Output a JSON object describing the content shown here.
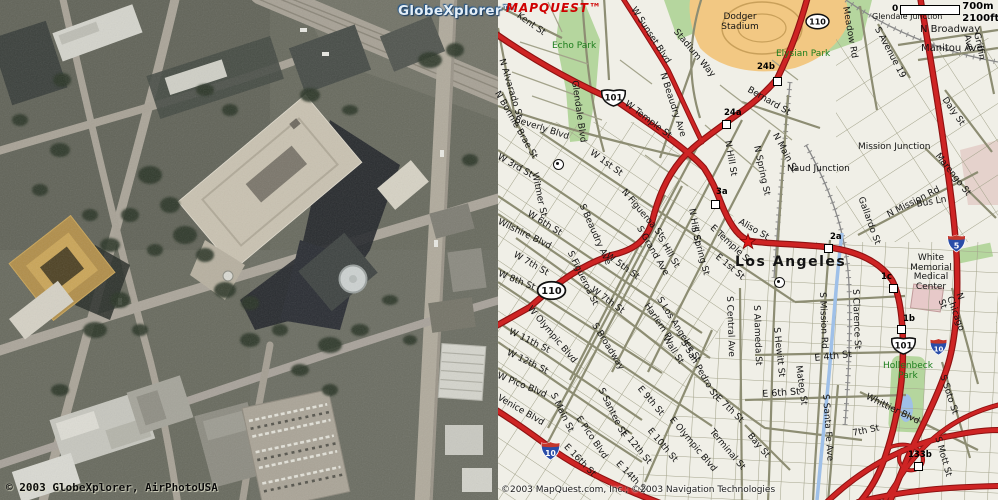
{
  "left_panel": {
    "watermark": "GlobeXplorer™",
    "copyright": "© 2003 GlobeXplorer, AirPhotoUSA"
  },
  "map_panel": {
    "logo": "MAPQUEST™",
    "scale": {
      "zero": "0",
      "metric": "700m",
      "imperial": "2100ft"
    },
    "copyright": "©2003 MapQuest.com, Inc.; ©2003 Navigation Technologies",
    "colors": {
      "map_background": "#f0efe7",
      "freeway_red": "#ce2424",
      "freeway_casing": "#8f1212",
      "street_olive": "#8d8d73",
      "park_green_fill": "#b5d69e",
      "park_green_text": "#1c7d1c",
      "stadium_orange": "#f2c883",
      "river_blue": "#9fc0e8",
      "logo_red": "#cf0000"
    },
    "labels": [
      {
        "t": "Kent St",
        "x": 520,
        "y": 12,
        "r": 35
      },
      {
        "t": "Echo Park",
        "x": 552,
        "y": 42,
        "c": "green"
      },
      {
        "t": "N Alvarado St",
        "x": 505,
        "y": 58,
        "r": 73
      },
      {
        "t": "Glendale Blvd",
        "x": 578,
        "y": 80,
        "r": 82
      },
      {
        "t": "N Bonnie Brae St",
        "x": 500,
        "y": 90,
        "r": 60
      },
      {
        "t": "Beverly Blvd",
        "x": 516,
        "y": 116,
        "r": 18
      },
      {
        "t": "W Sunset Blvd",
        "x": 636,
        "y": 6,
        "r": 57
      },
      {
        "t": "Stadium Way",
        "x": 678,
        "y": 28,
        "r": 50
      },
      {
        "t": "Dodger\nStadium",
        "x": 712,
        "y": 13,
        "w": 56,
        "align": "center"
      },
      {
        "t": "Elysian Park",
        "x": 776,
        "y": 50,
        "c": "green"
      },
      {
        "t": "W Temple St",
        "x": 628,
        "y": 100,
        "r": 37
      },
      {
        "t": "N Beaudry Ave",
        "x": 666,
        "y": 72,
        "r": 72
      },
      {
        "t": "Bernard St",
        "x": 750,
        "y": 86,
        "r": 30
      },
      {
        "t": "Meadow Rd",
        "x": 849,
        "y": 6,
        "r": 80
      },
      {
        "t": "Glendale Junction",
        "x": 872,
        "y": 13,
        "s": 8
      },
      {
        "t": "N Broadway",
        "x": 920,
        "y": 25,
        "s": 10
      },
      {
        "t": "Manitou Ave",
        "x": 921,
        "y": 44,
        "s": 10
      },
      {
        "t": "S Avenue 19",
        "x": 880,
        "y": 26,
        "r": 62
      },
      {
        "t": "Griffin Ave",
        "x": 980,
        "y": 32,
        "r": 78
      },
      {
        "t": "Daly St",
        "x": 947,
        "y": 96,
        "r": 55
      },
      {
        "t": "Mission Junction",
        "x": 858,
        "y": 143
      },
      {
        "t": "Naud Junction",
        "x": 787,
        "y": 165
      },
      {
        "t": "Marengo St",
        "x": 940,
        "y": 152,
        "r": 52
      },
      {
        "t": "N Mission Rd",
        "x": 886,
        "y": 212,
        "r": -27
      },
      {
        "t": "Bus Ln",
        "x": 916,
        "y": 201,
        "r": -10
      },
      {
        "t": "Gallardo St",
        "x": 864,
        "y": 196,
        "r": 70
      },
      {
        "t": "W 1st St",
        "x": 593,
        "y": 149,
        "r": 36
      },
      {
        "t": "N Figueroa St",
        "x": 626,
        "y": 188,
        "r": 50
      },
      {
        "t": "W 3rd St",
        "x": 500,
        "y": 153,
        "r": 30
      },
      {
        "t": "Witmer St",
        "x": 538,
        "y": 172,
        "r": 78
      },
      {
        "t": "N Hill St",
        "x": 731,
        "y": 140,
        "r": 80
      },
      {
        "t": "N Spring St",
        "x": 760,
        "y": 145,
        "r": 78
      },
      {
        "t": "N Main St",
        "x": 778,
        "y": 132,
        "r": 62
      },
      {
        "t": "N Hill St",
        "x": 695,
        "y": 208,
        "r": 80
      },
      {
        "t": "S Spring St",
        "x": 697,
        "y": 226,
        "r": 75
      },
      {
        "t": "S Hill St",
        "x": 663,
        "y": 235,
        "r": 60
      },
      {
        "t": "S Grand Ave",
        "x": 642,
        "y": 225,
        "r": 60
      },
      {
        "t": "S Beaudry Ave",
        "x": 585,
        "y": 203,
        "r": 66
      },
      {
        "t": "S Figueroa St",
        "x": 573,
        "y": 250,
        "r": 64
      },
      {
        "t": "Wilshire Blvd",
        "x": 500,
        "y": 218,
        "r": 26
      },
      {
        "t": "W 6th St",
        "x": 530,
        "y": 210,
        "r": 32
      },
      {
        "t": "W 5th St",
        "x": 609,
        "y": 252,
        "r": 36
      },
      {
        "t": "W 7th St",
        "x": 516,
        "y": 251,
        "r": 30
      },
      {
        "t": "W 7th St",
        "x": 594,
        "y": 286,
        "r": 36
      },
      {
        "t": "W 8th St",
        "x": 500,
        "y": 270,
        "r": 22
      },
      {
        "t": "W Olympic Blvd",
        "x": 532,
        "y": 305,
        "r": 50
      },
      {
        "t": "W 11th St",
        "x": 511,
        "y": 328,
        "r": 26
      },
      {
        "t": "W 12th St",
        "x": 509,
        "y": 349,
        "r": 26
      },
      {
        "t": "W Pico Blvd",
        "x": 499,
        "y": 372,
        "r": 22
      },
      {
        "t": "Venice Blvd",
        "x": 500,
        "y": 394,
        "r": 30
      },
      {
        "t": "S Broadway",
        "x": 597,
        "y": 322,
        "r": 58
      },
      {
        "t": "Harlem Pl",
        "x": 649,
        "y": 302,
        "r": 56
      },
      {
        "t": "S Los Angeles St",
        "x": 662,
        "y": 296,
        "r": 58
      },
      {
        "t": "S Main St",
        "x": 556,
        "y": 392,
        "r": 64
      },
      {
        "t": "S Santee St",
        "x": 604,
        "y": 387,
        "r": 64
      },
      {
        "t": "E Pico Blvd",
        "x": 581,
        "y": 415,
        "r": 56
      },
      {
        "t": "E 9th St",
        "x": 642,
        "y": 385,
        "r": 50
      },
      {
        "t": "E Olympic Blvd",
        "x": 674,
        "y": 416,
        "r": 50
      },
      {
        "t": "E 10th St",
        "x": 652,
        "y": 427,
        "r": 50
      },
      {
        "t": "E 12th St",
        "x": 626,
        "y": 429,
        "r": 50
      },
      {
        "t": "E 16th St",
        "x": 568,
        "y": 443,
        "r": 46
      },
      {
        "t": "E 14th St",
        "x": 620,
        "y": 460,
        "r": 46
      },
      {
        "t": "Wall St",
        "x": 668,
        "y": 335,
        "r": 58
      },
      {
        "t": "S San Pedro St",
        "x": 686,
        "y": 339,
        "r": 60
      },
      {
        "t": "E Temple St",
        "x": 714,
        "y": 224,
        "r": 43
      },
      {
        "t": "Aliso St",
        "x": 741,
        "y": 218,
        "r": 30
      },
      {
        "t": "E 1st St",
        "x": 719,
        "y": 253,
        "r": 40
      },
      {
        "t": "Los Angeles",
        "x": 735,
        "y": 255,
        "s": 14,
        "b": 1,
        "ls": 1.5
      },
      {
        "t": "S Central Ave",
        "x": 733,
        "y": 296,
        "r": 88
      },
      {
        "t": "S Alameda St",
        "x": 760,
        "y": 305,
        "r": 88
      },
      {
        "t": "S Hewitt St",
        "x": 780,
        "y": 327,
        "r": 84
      },
      {
        "t": "Mateo St",
        "x": 802,
        "y": 365,
        "r": 82
      },
      {
        "t": "S Mission Rd",
        "x": 826,
        "y": 292,
        "r": 88
      },
      {
        "t": "S Clarence St",
        "x": 859,
        "y": 289,
        "r": 88
      },
      {
        "t": "E 4th St",
        "x": 814,
        "y": 354,
        "r": -6,
        "s": 9.5
      },
      {
        "t": "E 6th St",
        "x": 762,
        "y": 390,
        "r": -4,
        "s": 9.5
      },
      {
        "t": "E 7th St",
        "x": 719,
        "y": 394,
        "r": 44
      },
      {
        "t": "Terminal St",
        "x": 714,
        "y": 428,
        "r": 50
      },
      {
        "t": "Bay St",
        "x": 752,
        "y": 432,
        "r": 50
      },
      {
        "t": "S Santa Fe Ave",
        "x": 829,
        "y": 394,
        "r": 86
      },
      {
        "t": "White\nMemorial\nMedical\nCenter",
        "x": 902,
        "y": 254,
        "w": 58,
        "align": "center"
      },
      {
        "t": "N Chicago St",
        "x": 962,
        "y": 292,
        "r": 70
      },
      {
        "t": "Hollenbeck\nPark",
        "x": 878,
        "y": 362,
        "c": "green",
        "w": 60,
        "align": "center"
      },
      {
        "t": "S Soto St",
        "x": 946,
        "y": 374,
        "r": 72
      },
      {
        "t": "Whittier Blvd",
        "x": 868,
        "y": 393,
        "r": 26
      },
      {
        "t": "7th St",
        "x": 852,
        "y": 430,
        "r": -12
      },
      {
        "t": "S Mott St",
        "x": 941,
        "y": 436,
        "r": 74
      }
    ],
    "exits": [
      {
        "label": "24b",
        "lx": 757,
        "ly": 62,
        "sx": 773,
        "sy": 77
      },
      {
        "label": "24a",
        "lx": 724,
        "ly": 108,
        "sx": 722,
        "sy": 120
      },
      {
        "label": "3a",
        "lx": 716,
        "ly": 187,
        "sx": 711,
        "sy": 200
      },
      {
        "label": "2a",
        "lx": 830,
        "ly": 232,
        "sx": 824,
        "sy": 244
      },
      {
        "label": "1c",
        "lx": 881,
        "ly": 272,
        "sx": 889,
        "sy": 284
      },
      {
        "label": "1b",
        "lx": 903,
        "ly": 314,
        "sx": 897,
        "sy": 325
      },
      {
        "label": "133b",
        "lx": 908,
        "ly": 450,
        "sx": 914,
        "sy": 462
      }
    ],
    "shields": [
      {
        "type": "us",
        "text": "101",
        "x": 600,
        "y": 88,
        "w": 27,
        "h": 19
      },
      {
        "type": "us",
        "text": "101",
        "x": 890,
        "y": 336,
        "w": 27,
        "h": 19
      },
      {
        "type": "state",
        "text": "110",
        "x": 804,
        "y": 13,
        "w": 27,
        "h": 17
      },
      {
        "type": "state",
        "text": "110",
        "x": 536,
        "y": 280,
        "w": 31,
        "h": 21
      },
      {
        "type": "interstate",
        "text": "5",
        "x": 947,
        "y": 234,
        "w": 19,
        "h": 19
      },
      {
        "type": "interstate",
        "text": "10",
        "x": 537,
        "y": 441,
        "w": 27,
        "h": 20
      },
      {
        "type": "interstate",
        "text": "10",
        "x": 927,
        "y": 338,
        "w": 23,
        "h": 18
      }
    ],
    "pois": [
      {
        "x": 774,
        "y": 277
      },
      {
        "x": 553,
        "y": 159
      }
    ],
    "star": {
      "x": 739,
      "y": 233
    }
  }
}
